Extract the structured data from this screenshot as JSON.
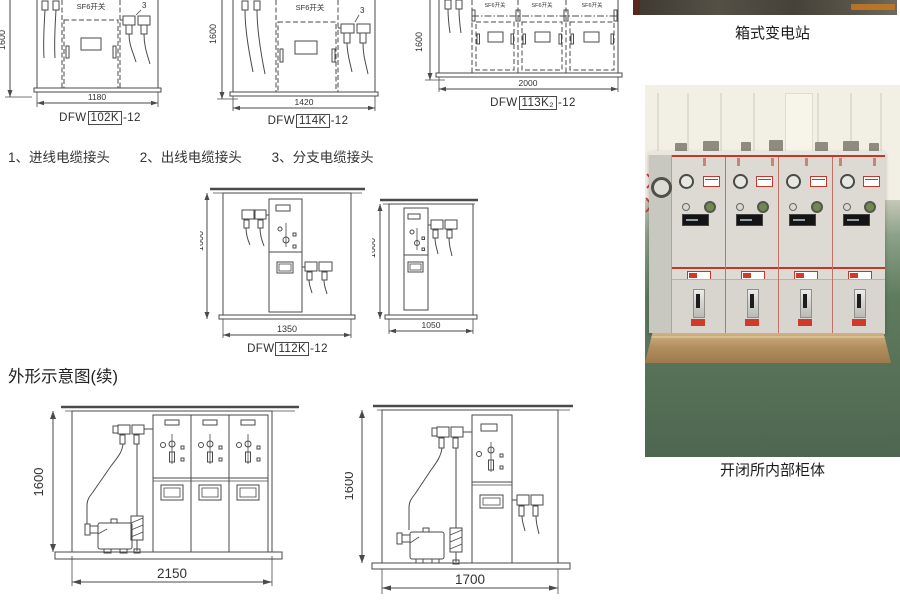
{
  "legend": {
    "item_1": "1、进线电缆接头",
    "item_2": "2、出线电缆接头",
    "item_3": "3、分支电缆接头"
  },
  "section_heading": "外形示意图(续)",
  "labels": {
    "sf6_switch": "SF6开关",
    "callout_3": "3"
  },
  "drawings": {
    "d1": {
      "width_dim": "1180",
      "height_dim": "1600",
      "model_prefix": "DFW",
      "model_code": "102K",
      "model_suffix": "-12"
    },
    "d2": {
      "width_dim": "1420",
      "height_dim": "1600",
      "model_prefix": "DFW",
      "model_code": "114K",
      "model_suffix": "-12"
    },
    "d3": {
      "width_dim": "2000",
      "height_dim": "1600",
      "model_prefix": "DFW",
      "model_code": "113K₂",
      "model_suffix": "-12"
    },
    "d4": {
      "width_dim": "1350",
      "height_dim": "1600",
      "model_prefix": "DFW",
      "model_code": "112K",
      "model_suffix": "-12"
    },
    "d5": {
      "width_dim": "1050",
      "height_dim": "1600"
    },
    "d6": {
      "width_dim": "2150",
      "height_dim": "1600"
    },
    "d7": {
      "width_dim": "1700",
      "height_dim": "1600"
    }
  },
  "photos": {
    "top_caption": "箱式变电站",
    "bottom_caption": "开闭所内部柜体"
  },
  "colors": {
    "line": "#4a4a4a",
    "photo_red": "#c0392b",
    "floor_green": "#5f7b5e",
    "pallet_tan": "#b3905f"
  }
}
